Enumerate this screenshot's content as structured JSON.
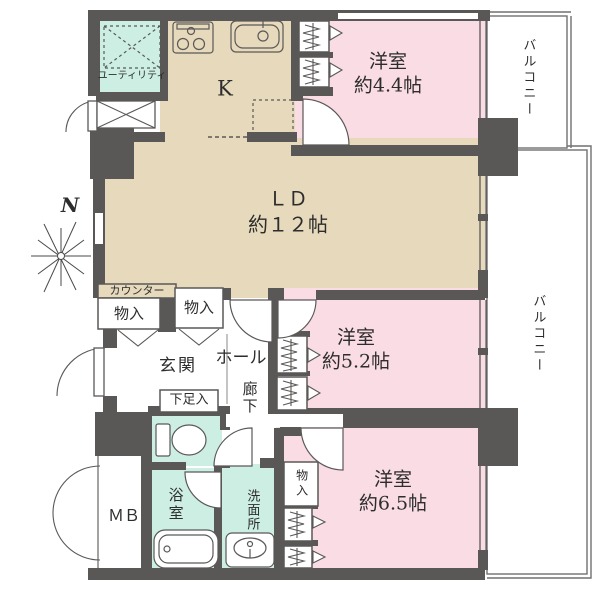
{
  "title": "マンション間取り図",
  "compass": {
    "label": "N"
  },
  "colors": {
    "wall": "#5a5857",
    "room_beige": "#e6d9bc",
    "room_pink": "#f9dce4",
    "room_mint": "#cdeee2",
    "balcony_line": "#707070",
    "text": "#2d2d2d"
  },
  "rooms": {
    "utility": {
      "label": "ユーティリティ"
    },
    "kitchen": {
      "label": "K"
    },
    "bedroom_44": {
      "label": "洋室",
      "size": "約4.4帖"
    },
    "living_dining": {
      "label": "ＬＤ",
      "size": "約１２帖"
    },
    "bedroom_52": {
      "label": "洋室",
      "size": "約5.2帖"
    },
    "bedroom_65": {
      "label": "洋室",
      "size": "約6.5帖"
    },
    "entrance": {
      "label": "玄関"
    },
    "hall": {
      "label": "ホール"
    },
    "corridor": {
      "label": "廊下"
    },
    "shoe_cabinet": {
      "label": "下足入"
    },
    "bathroom": {
      "label": "浴室"
    },
    "washroom": {
      "label": "洗面所"
    },
    "meter_box": {
      "label": "ＭＢ"
    },
    "counter": {
      "label": "カウンター"
    },
    "storage_left": {
      "label": "物入"
    },
    "storage_right": {
      "label": "物入"
    },
    "storage_bottom": {
      "label": "物入"
    },
    "balcony_top": {
      "label": "バルコニー"
    },
    "balcony_right": {
      "label": "バルコニー"
    }
  }
}
